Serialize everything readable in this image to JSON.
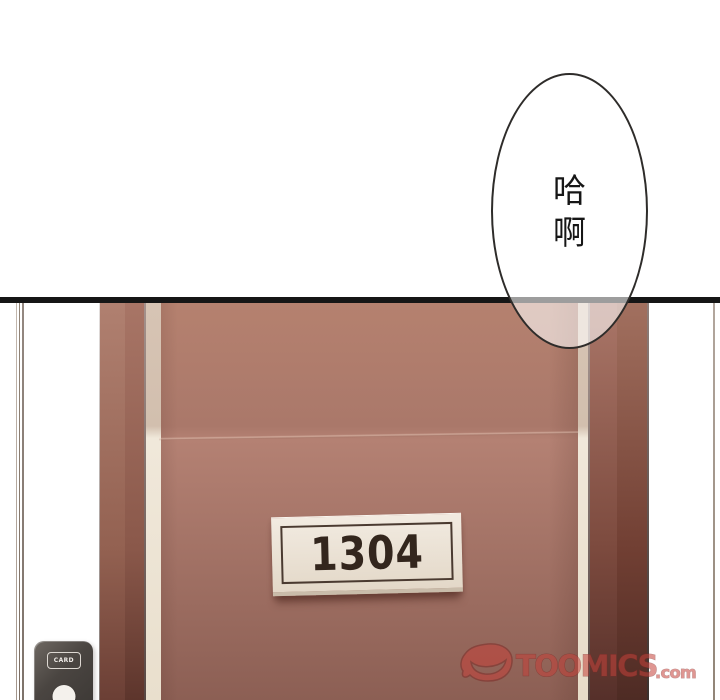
{
  "speech_bubble": {
    "lines": [
      "哈",
      "啊"
    ]
  },
  "door": {
    "plate_number": "1304"
  },
  "card_reader": {
    "label": "CARD"
  },
  "watermark": {
    "brand": "TOOMICS",
    "domain_suffix": ".com"
  },
  "colors": {
    "line_black": "#161616",
    "slab_top": "#b5816f",
    "slab_bottom": "#8c5f54",
    "frame_dark": "#5d352c",
    "jamb_cream": "#e9dfcd",
    "plaque_face": "#f2ebe1",
    "plaque_text": "#33261d",
    "reader_body": "#4a4541",
    "reader_button": "#f4f1ec",
    "watermark_red": "#c5413a",
    "watermark_red_dark": "#7e2a26"
  }
}
